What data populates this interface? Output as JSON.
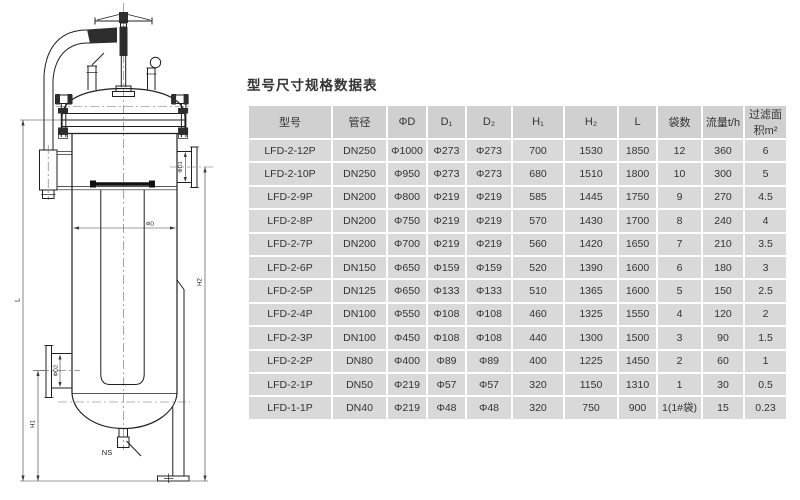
{
  "colors": {
    "cell_bg": "#d9d9d9",
    "header_bg": "#d0d0d0",
    "ink": "#2f2f2f",
    "line": "#1f1f1f"
  },
  "diagram": {
    "labels": {
      "phi_d": "ΦD",
      "phi_d1": "ΦD1",
      "phi_d2": "ΦD2",
      "l": "L",
      "h1": "H1",
      "h2": "H2",
      "ns": "NS"
    }
  },
  "table": {
    "title": "型号尺寸规格数据表",
    "headers": [
      "型号",
      "管径",
      "ΦD",
      "D₁",
      "D₂",
      "H₁",
      "H₂",
      "L",
      "袋数",
      "流量t/h",
      "过滤面积m²"
    ],
    "rows": [
      [
        "LFD-2-12P",
        "DN250",
        "Φ1000",
        "Φ273",
        "Φ273",
        "700",
        "1530",
        "1850",
        "12",
        "360",
        "6"
      ],
      [
        "LFD-2-10P",
        "DN250",
        "Φ950",
        "Φ273",
        "Φ273",
        "680",
        "1510",
        "1800",
        "10",
        "300",
        "5"
      ],
      [
        "LFD-2-9P",
        "DN200",
        "Φ800",
        "Φ219",
        "Φ219",
        "585",
        "1445",
        "1750",
        "9",
        "270",
        "4.5"
      ],
      [
        "LFD-2-8P",
        "DN200",
        "Φ750",
        "Φ219",
        "Φ219",
        "570",
        "1430",
        "1700",
        "8",
        "240",
        "4"
      ],
      [
        "LFD-2-7P",
        "DN200",
        "Φ700",
        "Φ219",
        "Φ219",
        "560",
        "1420",
        "1650",
        "7",
        "210",
        "3.5"
      ],
      [
        "LFD-2-6P",
        "DN150",
        "Φ650",
        "Φ159",
        "Φ159",
        "520",
        "1390",
        "1600",
        "6",
        "180",
        "3"
      ],
      [
        "LFD-2-5P",
        "DN125",
        "Φ650",
        "Φ133",
        "Φ133",
        "510",
        "1365",
        "1600",
        "5",
        "150",
        "2.5"
      ],
      [
        "LFD-2-4P",
        "DN100",
        "Φ550",
        "Φ108",
        "Φ108",
        "460",
        "1325",
        "1550",
        "4",
        "120",
        "2"
      ],
      [
        "LFD-2-3P",
        "DN100",
        "Φ450",
        "Φ108",
        "Φ108",
        "440",
        "1300",
        "1500",
        "3",
        "90",
        "1.5"
      ],
      [
        "LFD-2-2P",
        "DN80",
        "Φ400",
        "Φ89",
        "Φ89",
        "400",
        "1225",
        "1450",
        "2",
        "60",
        "1"
      ],
      [
        "LFD-2-1P",
        "DN50",
        "Φ219",
        "Φ57",
        "Φ57",
        "320",
        "1150",
        "1310",
        "1",
        "30",
        "0.5"
      ],
      [
        "LFD-1-1P",
        "DN40",
        "Φ219",
        "Φ48",
        "Φ48",
        "320",
        "750",
        "900",
        "1(1#袋)",
        "15",
        "0.23"
      ]
    ]
  }
}
